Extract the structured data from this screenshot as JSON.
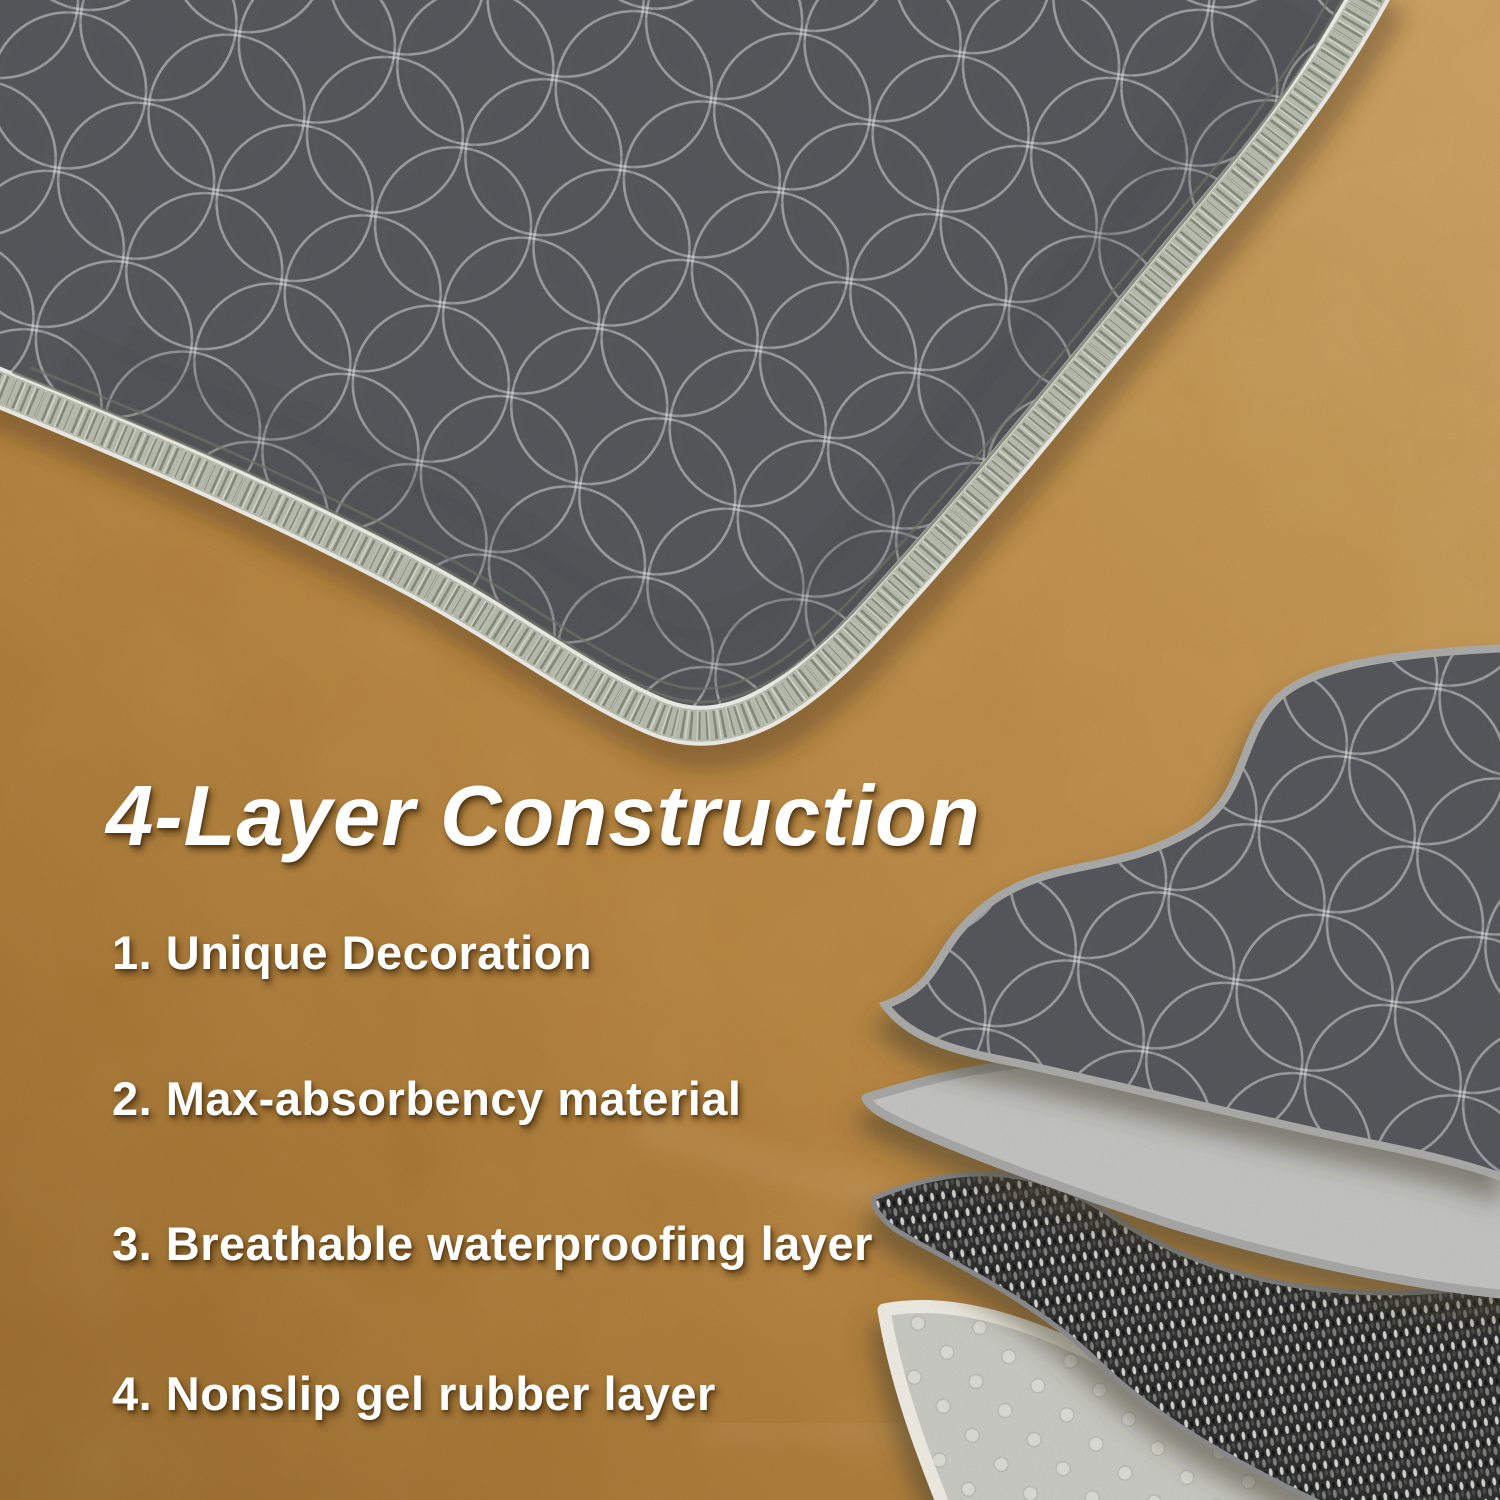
{
  "header": {
    "title": "4-Layer Construction"
  },
  "features": {
    "items": [
      "1. Unique Decoration",
      "2. Max-absorbency material",
      "3. Breathable waterproofing layer",
      "4. Nonslip gel rubber layer"
    ]
  },
  "scene": {
    "floor": {
      "color_light": "#c79d5f",
      "color_mid": "#b3813d",
      "color_dark": "#9a6e30"
    },
    "mat": {
      "fabric_base": "#cfcecb",
      "fabric_white_patch": "#efeeeb",
      "fabric_speckle_dark": "#43464a",
      "trim_serge": "#b6baac",
      "trim_rib": "#7d8071",
      "stitch_line": "#6f7363"
    },
    "diagram_layers": [
      {
        "name": "decorative-fabric-layer",
        "fill": "speckled-fabric",
        "edge": "#a8a8a6"
      },
      {
        "name": "absorbent-material-layer",
        "fill": "#c1c2c0",
        "edge": "#a5a6a4"
      },
      {
        "name": "waterproof-membrane-layer",
        "fill": "#2d2e2e",
        "edge": "#87898a"
      },
      {
        "name": "nonslip-gel-rubber-layer",
        "fill": "#c6c7c1",
        "edge": "#ebe9df"
      }
    ],
    "text_color": "#ffffff"
  }
}
